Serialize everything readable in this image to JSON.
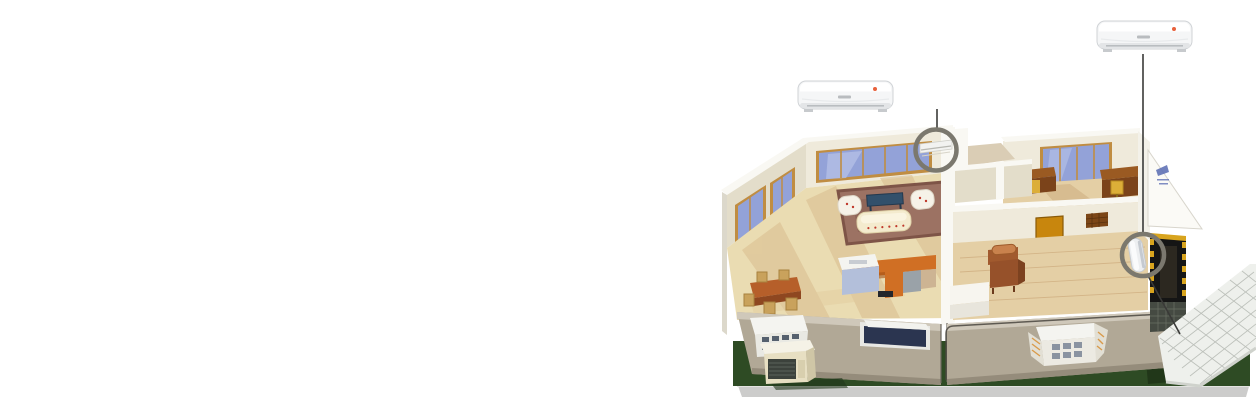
{
  "scene": {
    "description": "Isometric cutaway illustration of a two-section house showing wall-mounted split air-conditioner installation points",
    "background": "#ffffff"
  },
  "labels": {
    "illustration": "House cutaway with air conditioner placement",
    "ac_left": "Split AC indoor unit - living room",
    "ac_right": "Split AC indoor unit - bedroom",
    "callout_left": "Installed indoor unit location (living room wall)",
    "callout_right": "Installed indoor unit location (bedroom wall)",
    "outdoor_unit": "Outdoor condenser unit on lawn",
    "left_house": "Living room and kitchen section",
    "right_house": "Office and bedroom section",
    "patio": "Tiled entrance patio",
    "lawn": "Lawn base"
  },
  "palette": {
    "lawn": "#2e4b24",
    "lawnShadow": "#1e3417",
    "baseCurb": "#cccccb",
    "baseCurbTop": "#e3e3e1",
    "facade": "#b1a896",
    "facadeTop": "#cfc8ba",
    "wallCream": "#efeadb",
    "wallCreamShade": "#e3ddca",
    "wallWhite": "#f9f8f3",
    "floorWood": "#eadcb2",
    "floorBand": "#d9bd8e",
    "floorRight": "#e4cfa5",
    "rug": "#9c7263",
    "rugBorder": "#7e5447",
    "windowBlue": "#93a2d8",
    "windowFrame": "#c08d42",
    "sofa": "#f4ebce",
    "tableNavy": "#32506b",
    "counterOrange": "#d06f24",
    "islandBlue": "#b3bfda",
    "woodBrown": "#9a5a22",
    "woodBrownDark": "#7b431a",
    "doorOrange": "#c8860d",
    "chairYellow": "#dcae38",
    "chairBrown": "#a15a2e",
    "entranceYellow": "#d8a41e",
    "entranceDark": "#151515",
    "patioTile": "#eef0ec",
    "patioLine": "#bcc0ba",
    "gableWhite": "#fbfaf6",
    "decalBlue": "#6172b6",
    "acBody": "#f5f6f7",
    "acEdge": "#d0d3d6",
    "acVent": "#b9bdc0",
    "accentRed": "#e8613c",
    "ring": "#7b786e",
    "leader": "#3a3a38",
    "outlineDark": "#4a463f",
    "outdoorBeige": "#e7dfc2",
    "grille": "#3c423c",
    "matBrown": "#7c4617"
  }
}
